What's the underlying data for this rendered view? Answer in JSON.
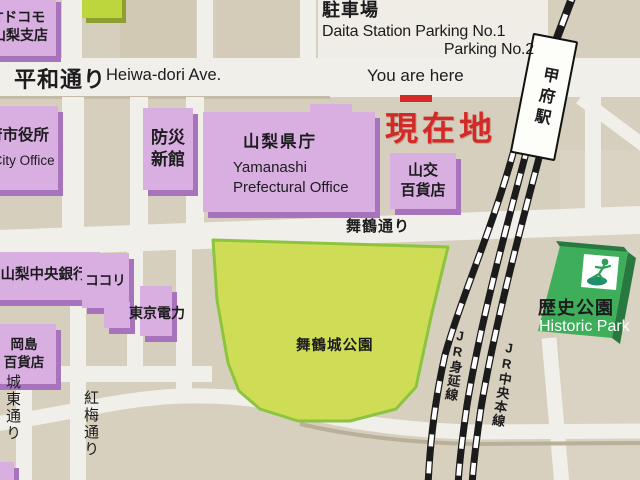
{
  "meta": {
    "description": "Illustrated area guide map signboard around Kofu Station",
    "current_location_marker": "現在地"
  },
  "colors": {
    "background_tan": "#d7cfbd",
    "road_white": "#f1efe9",
    "parking_area_white": "#efede6",
    "building_purple": "#d9aee1",
    "building_purple_side": "#a873bd",
    "park_green_fill": "#cedd55",
    "park_green_edge": "#8cc43f",
    "historic_green": "#3fae5b",
    "historic_green_side": "#27793f",
    "small_green_building": "#bdd63e",
    "rail_black": "#1b1b1b",
    "accent_red": "#d32a28",
    "text_black": "#1c1c1e",
    "station_white": "#fdfdf9"
  },
  "labels": {
    "parking_title": "駐車場",
    "parking_line1": "Daita Station Parking No.1",
    "parking_line2": "Parking No.2",
    "you_are_here": "You are here",
    "genzaichi": "現在地",
    "heiwa_jp": "平和通り",
    "heiwa_en": "Heiwa-dori Ave.",
    "maizuru_ave": "舞鶴通り",
    "maizuru_park": "舞鶴城公園",
    "historic_jp": "歴史公園",
    "historic_en": "Historic Park",
    "joto_st": "城東通り",
    "kobai_st": "紅梅通り",
    "station": "甲府駅",
    "jr_minobu": "JR身延線",
    "jr_chuo": "JR中央本線"
  },
  "buildings": {
    "ntt": {
      "line1": "Tドコモ",
      "line2": "山梨支店"
    },
    "city_office": {
      "line1": "府市役所",
      "line2": "u City Office"
    },
    "bosai": {
      "line1": "防災",
      "line2": "新館"
    },
    "pref_office": {
      "jp": "山梨県庁",
      "en1": "Yamanashi",
      "en2": "Prefectural Office"
    },
    "yamako": {
      "line1": "山交",
      "line2": "百貨店"
    },
    "chuo_bank": {
      "line1": "山梨中央銀行"
    },
    "cocori": {
      "line1": "ココリ"
    },
    "tepco": {
      "line1": "東京電力"
    },
    "okajima": {
      "line1": "岡島",
      "line2": "百貨店"
    }
  },
  "icons": {
    "historic_park_pictogram": "person-in-park-icon"
  }
}
